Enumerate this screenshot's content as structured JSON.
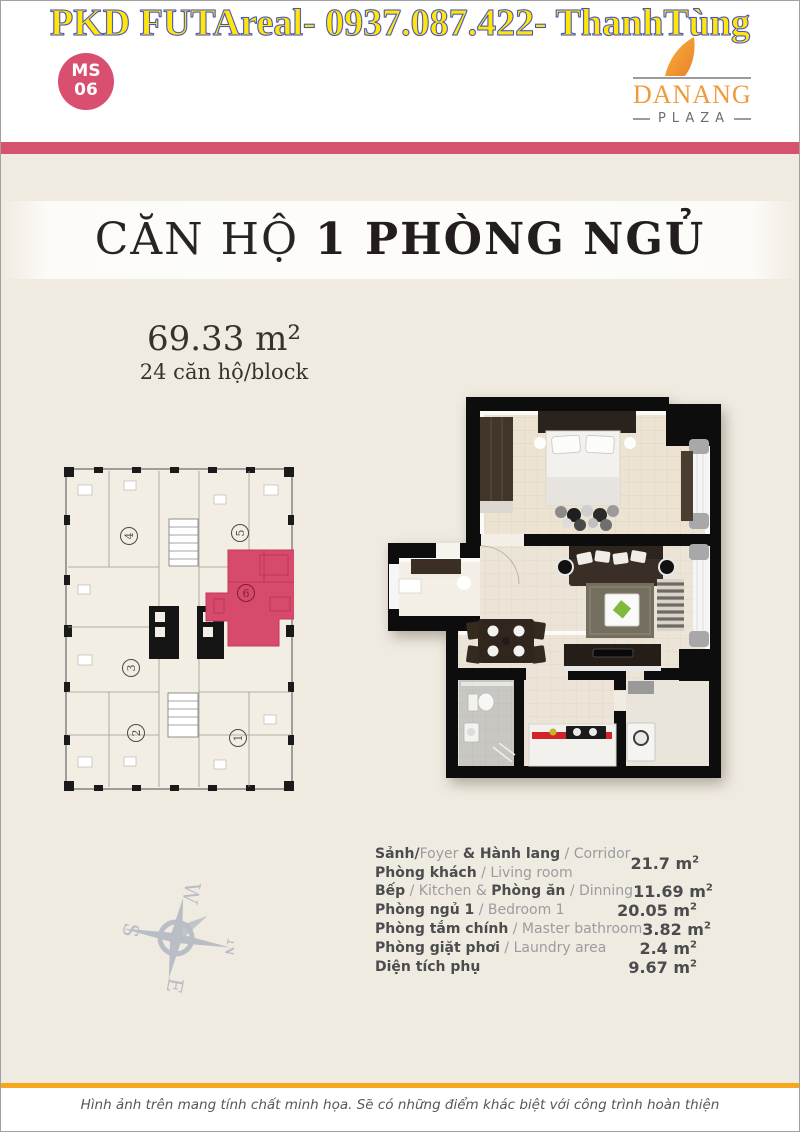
{
  "banner": {
    "hotline_text": "PKD FUTAreal- 0937.087.422- ThanhTùng"
  },
  "badge": {
    "top": "MS",
    "bottom": "06"
  },
  "logo": {
    "brand": "DANANG",
    "sub": "PLAZA"
  },
  "title": {
    "normal": "CĂN HỘ ",
    "bold": "1 PHÒNG NGỦ"
  },
  "area": {
    "size": "69.33 m²",
    "per_block": "24 căn hộ/block"
  },
  "building_plan": {
    "highlighted_unit": "6",
    "units": [
      {
        "n": "4",
        "x": 65,
        "y": 69,
        "rot": -90,
        "hl": false
      },
      {
        "n": "5",
        "x": 176,
        "y": 66,
        "rot": -90,
        "hl": false
      },
      {
        "n": "6",
        "x": 182,
        "y": 126,
        "rot": 0,
        "hl": true
      },
      {
        "n": "3",
        "x": 67,
        "y": 201,
        "rot": -90,
        "hl": false
      },
      {
        "n": "2",
        "x": 72,
        "y": 266,
        "rot": -90,
        "hl": false
      },
      {
        "n": "1",
        "x": 174,
        "y": 271,
        "rot": -90,
        "hl": false
      }
    ]
  },
  "compass": {
    "letters": [
      {
        "t": "N",
        "x": 57,
        "y": 26
      },
      {
        "t": "E",
        "x": 104,
        "y": 77
      },
      {
        "t": "S",
        "x": 57,
        "y": 130
      },
      {
        "t": "W",
        "x": 10,
        "y": 77
      }
    ]
  },
  "room_table": {
    "unit_base": "m",
    "unit_sup": "2",
    "rows": [
      {
        "lines": [
          [
            {
              "b": true,
              "t": "Sảnh/"
            },
            {
              "b": false,
              "t": "Foyer "
            },
            {
              "b": true,
              "t": "& Hành lang"
            },
            {
              "b": false,
              "t": " / Corridor"
            }
          ],
          [
            {
              "b": true,
              "t": "Phòng khách"
            },
            {
              "b": false,
              "t": " / Living room"
            }
          ]
        ],
        "value": "21.7"
      },
      {
        "lines": [
          [
            {
              "b": true,
              "t": "Bếp"
            },
            {
              "b": false,
              "t": " / Kitchen & "
            },
            {
              "b": true,
              "t": "Phòng ăn"
            },
            {
              "b": false,
              "t": " / Dinning"
            }
          ]
        ],
        "value": "11.69"
      },
      {
        "lines": [
          [
            {
              "b": true,
              "t": "Phòng ngủ 1"
            },
            {
              "b": false,
              "t": " / Bedroom 1"
            }
          ]
        ],
        "value": "20.05"
      },
      {
        "lines": [
          [
            {
              "b": true,
              "t": "Phòng tắm chính"
            },
            {
              "b": false,
              "t": " / Master bathroom"
            }
          ]
        ],
        "value": "3.82"
      },
      {
        "lines": [
          [
            {
              "b": true,
              "t": "Phòng giặt phơi"
            },
            {
              "b": false,
              "t": " / Laundry area"
            }
          ]
        ],
        "value": "2.4"
      },
      {
        "lines": [
          [
            {
              "b": true,
              "t": "Diện tích phụ"
            }
          ]
        ],
        "value": "9.67"
      }
    ]
  },
  "footer": {
    "disclaimer": "Hình ảnh trên mang tính chất minh họa. Sẽ có những điểm khác biệt với công trình hoàn thiện"
  },
  "colors": {
    "stripe_pink": "#d6536f",
    "badge_pink": "#d94f70",
    "unit_highlight_pink": "#d84a6b",
    "accent_orange": "#f5a71d",
    "banner_yellow": "#ffe607",
    "banner_outline_blue": "#4853c0",
    "logo_orange": "#ef9a3c",
    "background_beige": "#f0ebe1"
  }
}
